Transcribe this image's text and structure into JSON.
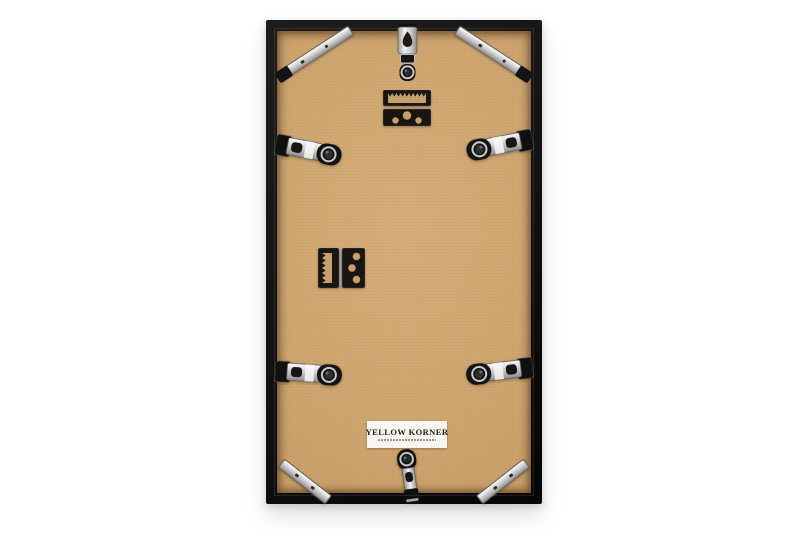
{
  "scene": {
    "background_color": "#ffffff",
    "subject": "back-of-picture-frame-product-photo",
    "frame_color": "#121212",
    "board_color": "#cda36d"
  },
  "label": {
    "brand": "YELLOW KORNER",
    "background": "#f8f6f1",
    "text_color": "#25201a"
  },
  "hardware": {
    "metal_light": "#fdfdfd",
    "metal_mid": "#c9c9c9",
    "metal_dark": "#8f8f8f",
    "black_metal": "#141414",
    "counts": {
      "corner_braces": 4,
      "side_flex_clips": 4,
      "sawtooth_hangers": 2,
      "top_keyhole_hanger": 1,
      "bottom_spring_clip": 1
    }
  }
}
